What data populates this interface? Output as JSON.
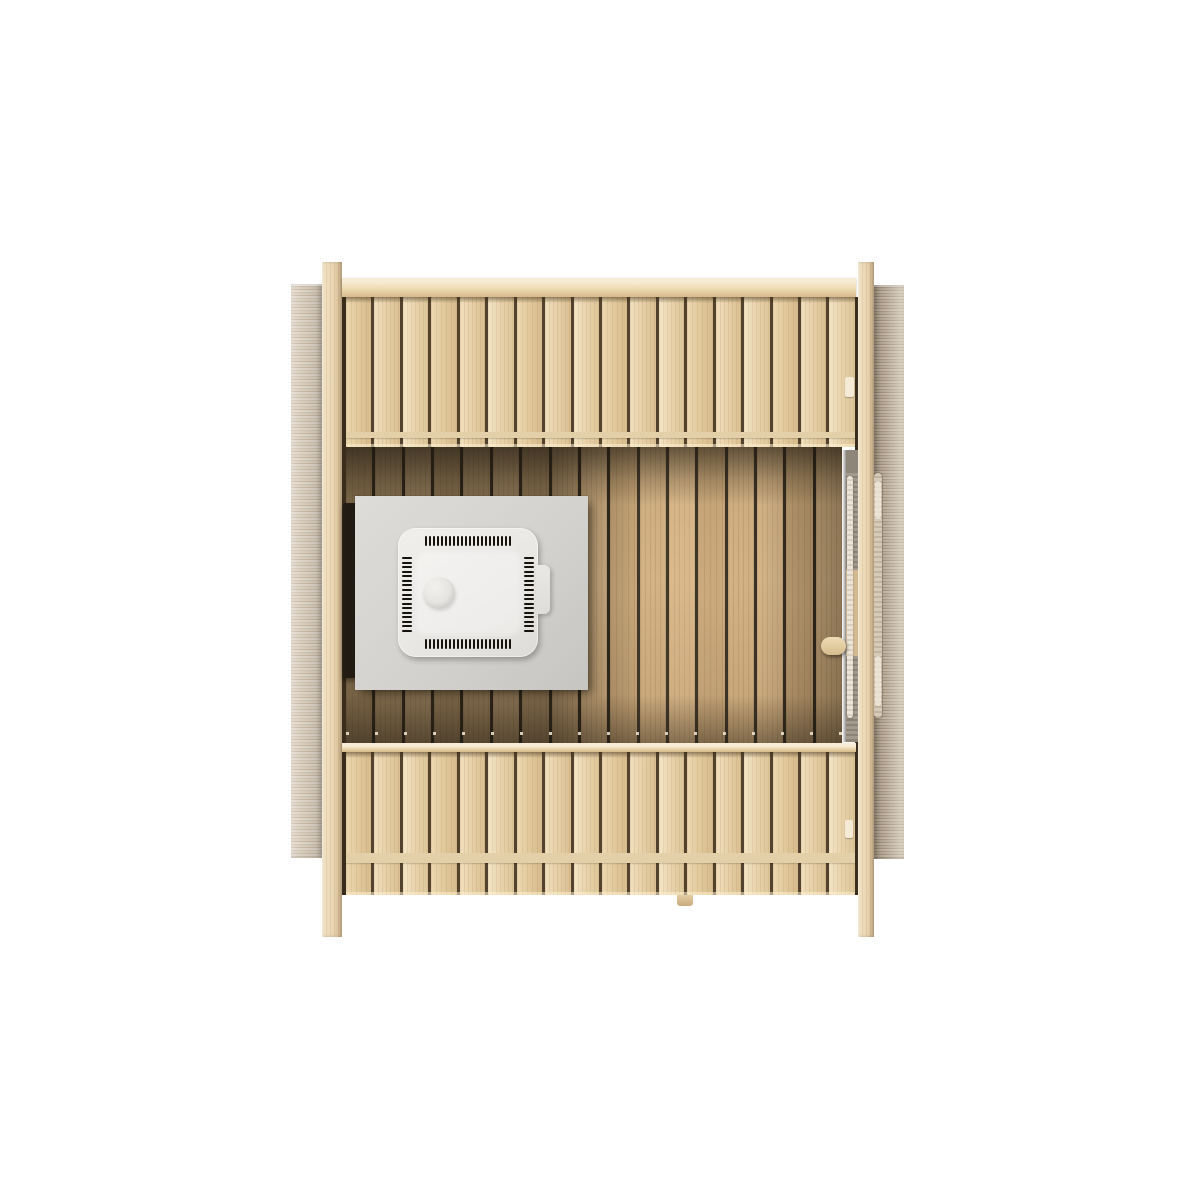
{
  "scene": {
    "description": "Top-down 3D product render of a wooden sauna cabin: two slatted pine benches, plank floor, electric heater on a grey protection plate with black wall guard, glass door with wooden handle on the right wall, grey exterior side walls and four corner posts, on a white background",
    "background_color": "#ffffff",
    "colors": {
      "bench_wood": "#e8d3ae",
      "bench_gap": "#53422d",
      "floor_plank": "#c9a87c",
      "floor_gap": "#2c251a",
      "rail_wood": "#ecd8ae",
      "post_wood": "#e9d6b2",
      "wall_left_grey": "#d9cfc1",
      "wall_right_grey": "#b6a997",
      "heater_plate_grey": "#d5d3d0",
      "heater_body_white": "#eceae7",
      "vent_slot_black": "#16130f",
      "heater_guard_black": "#221c14",
      "door_handle_wood": "#e2cda4"
    },
    "top_bench": {
      "slat_count": 18
    },
    "bottom_bench": {
      "slat_count": 18
    },
    "floor": {
      "plank_count": 17
    },
    "heater": {
      "vents": {
        "top": 22,
        "bottom": 22,
        "left": 17,
        "right": 17
      }
    },
    "parts": [
      "left-side-wall",
      "right-side-wall",
      "left-corner-post",
      "right-corner-post",
      "top-rail",
      "top-bench",
      "floor",
      "heater-wall-guard",
      "heater-base-plate",
      "sauna-heater",
      "door-top-edge",
      "door-handle",
      "bottom-rail",
      "bottom-bench"
    ]
  }
}
